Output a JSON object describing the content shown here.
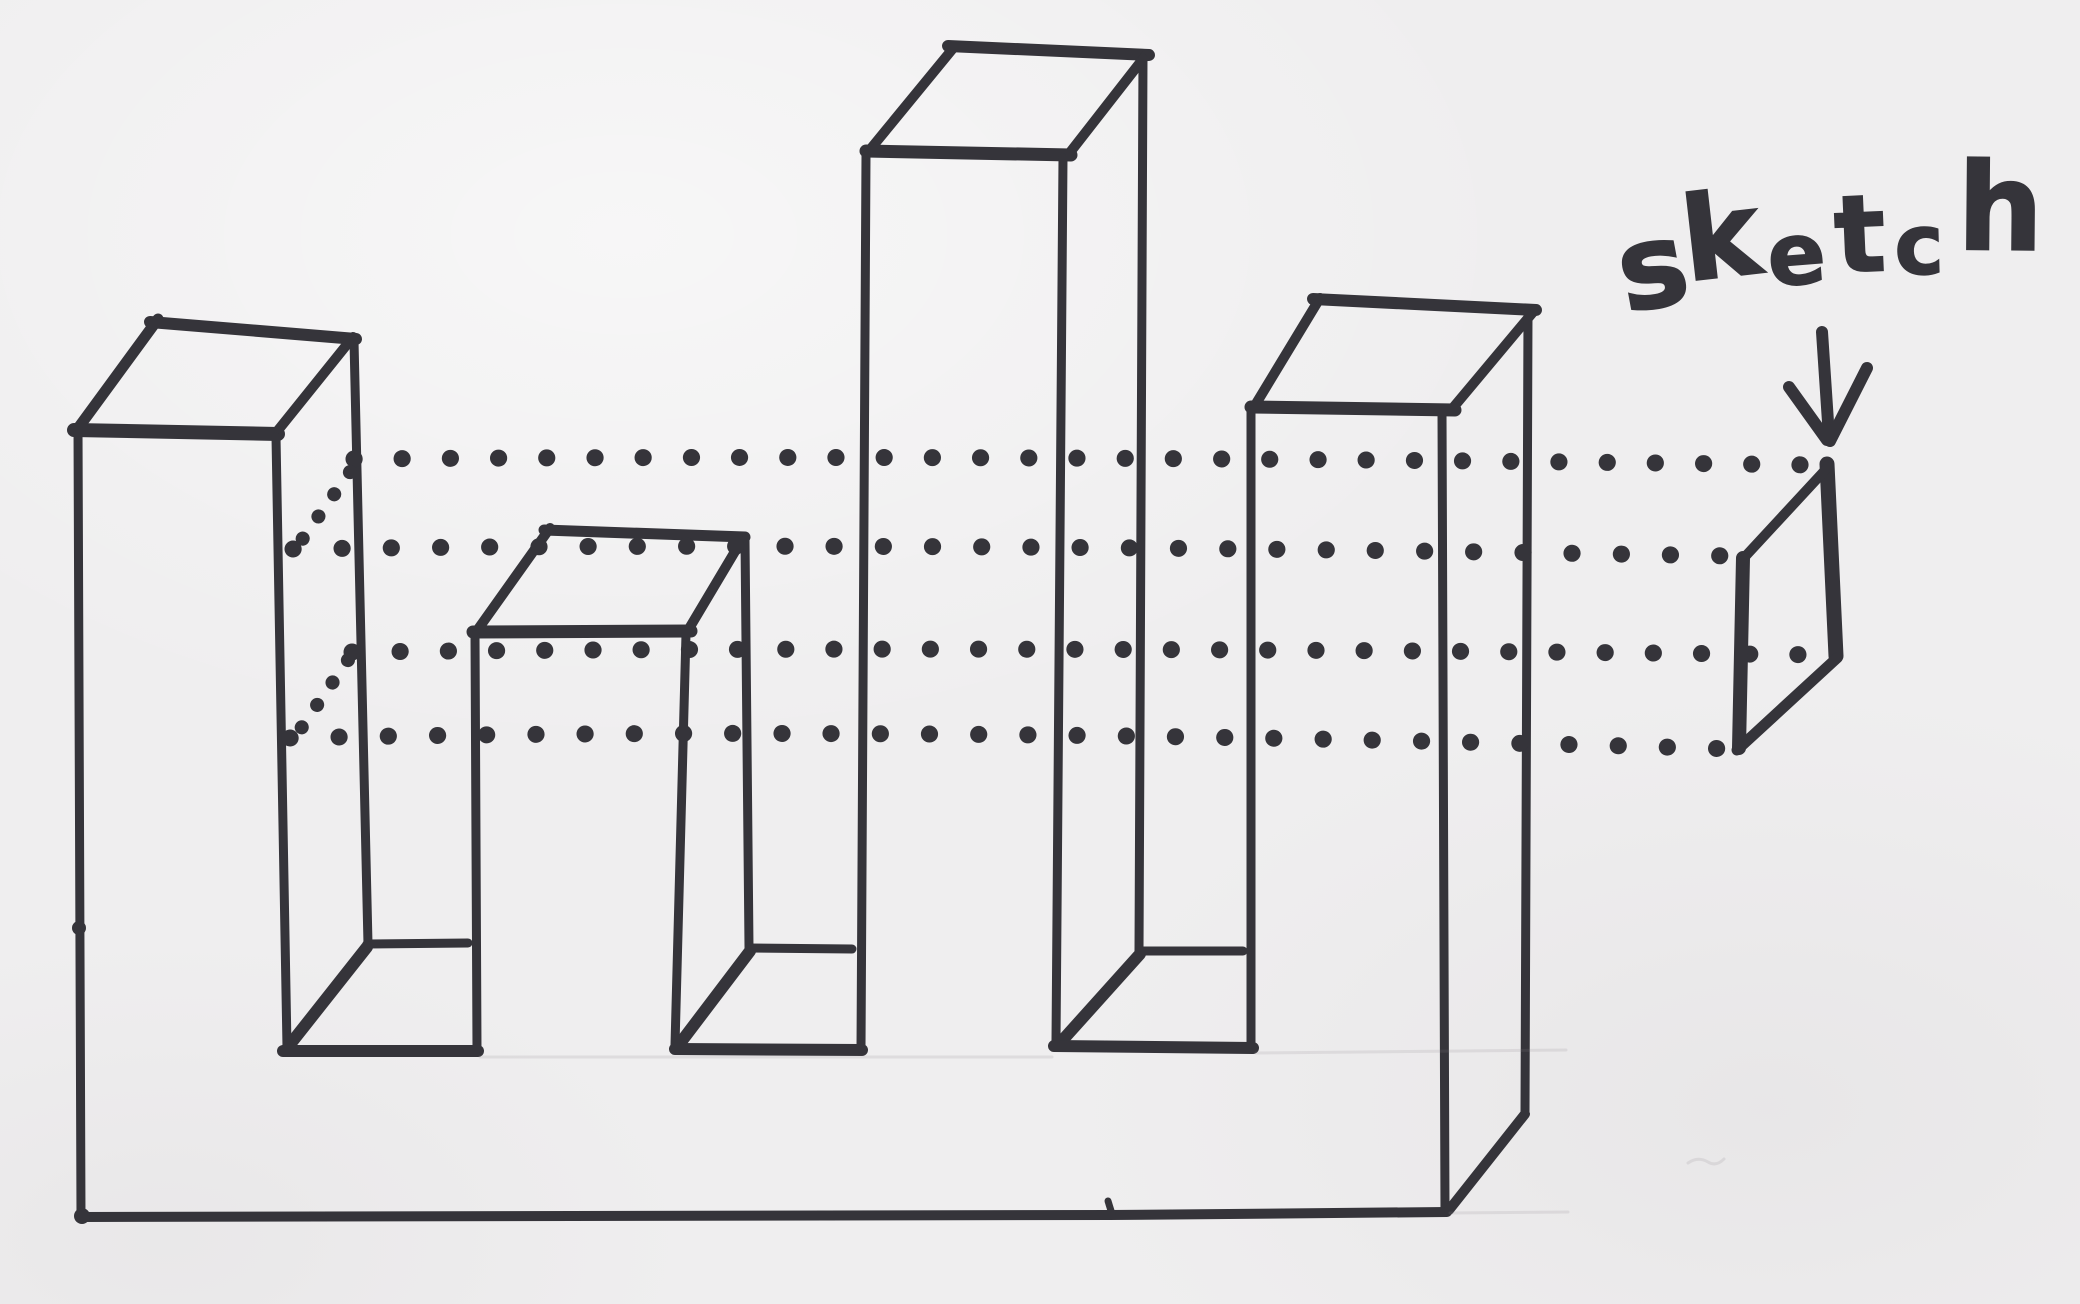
{
  "drawing": {
    "label": "sketch",
    "ink_color": "#35343a",
    "paper_color": "#efeeef",
    "pencil_color": "#8a8286",
    "tower_count": 4,
    "projection_row_count": 4,
    "projection_style": "dotted"
  }
}
